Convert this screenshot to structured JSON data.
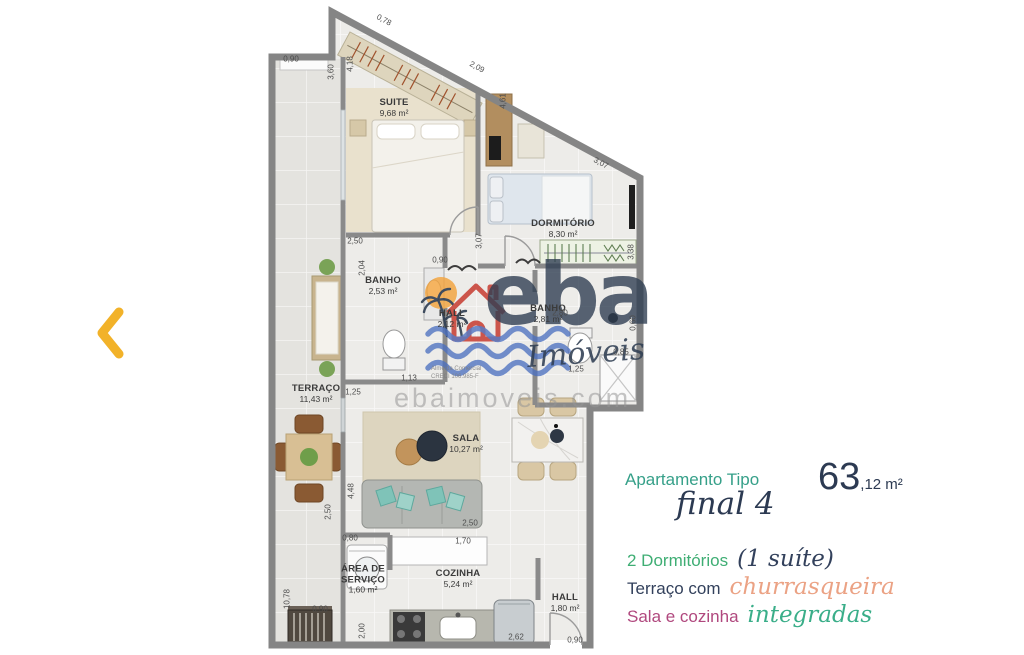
{
  "carousel": {
    "back_arrow_color": "#f2b229"
  },
  "watermark": {
    "brand": "eba",
    "brand_suffix": "Imóveis",
    "website": "ebaimoveis.com",
    "fine_print": [
      "Almeida Comercial",
      "CRECI 106.985-F"
    ],
    "colors": {
      "brand_navy": "#2f3e52",
      "house_red": "#c9453a",
      "sun_orange": "#f2a43f",
      "waves_blue": "#4a6fc0"
    }
  },
  "floorplan": {
    "rooms": [
      {
        "name": "SUITE",
        "area": "9,68 m²",
        "x": 394,
        "y": 108
      },
      {
        "name": "DORMITÓRIO",
        "area": "8,30 m²",
        "x": 563,
        "y": 229
      },
      {
        "name": "BANHO",
        "area": "2,53 m²",
        "x": 383,
        "y": 286
      },
      {
        "name": "HALL",
        "area": "2,12 m²",
        "x": 452,
        "y": 319
      },
      {
        "name": "BANHO",
        "area": "2,81 m²",
        "x": 548,
        "y": 314
      },
      {
        "name": "TERRAÇO",
        "area": "11,43 m²",
        "x": 316,
        "y": 394
      },
      {
        "name": "SALA",
        "area": "10,27 m²",
        "x": 466,
        "y": 444
      },
      {
        "name": "ÁREA DE\nSERVIÇO",
        "area": "1,60 m²",
        "x": 363,
        "y": 580
      },
      {
        "name": "COZINHA",
        "area": "5,24 m²",
        "x": 458,
        "y": 579
      },
      {
        "name": "HALL",
        "area": "1,80 m²",
        "x": 565,
        "y": 603
      }
    ],
    "dimensions": [
      {
        "t": "0,90",
        "x": 291,
        "y": 59,
        "r": 0
      },
      {
        "t": "3,60",
        "x": 331,
        "y": 72,
        "r": -90
      },
      {
        "t": "4,18",
        "x": 350,
        "y": 64,
        "r": -90
      },
      {
        "t": "0,78",
        "x": 384,
        "y": 20,
        "r": 28
      },
      {
        "t": "2,09",
        "x": 477,
        "y": 67,
        "r": 28
      },
      {
        "t": "4,61",
        "x": 503,
        "y": 101,
        "r": -90
      },
      {
        "t": "3,07",
        "x": 479,
        "y": 241,
        "r": -90
      },
      {
        "t": "3,07",
        "x": 601,
        "y": 163,
        "r": 28
      },
      {
        "t": "3,38",
        "x": 631,
        "y": 252,
        "r": -90
      },
      {
        "t": "2,50",
        "x": 355,
        "y": 241,
        "r": 0
      },
      {
        "t": "2,04",
        "x": 362,
        "y": 268,
        "r": -90
      },
      {
        "t": "0,90",
        "x": 440,
        "y": 260,
        "r": 0
      },
      {
        "t": "2,80",
        "x": 560,
        "y": 313,
        "r": 0
      },
      {
        "t": "0,60",
        "x": 633,
        "y": 323,
        "r": -90
      },
      {
        "t": "0,85",
        "x": 621,
        "y": 352,
        "r": 0
      },
      {
        "t": "1,25",
        "x": 576,
        "y": 369,
        "r": 0
      },
      {
        "t": "1,13",
        "x": 409,
        "y": 378,
        "r": 0
      },
      {
        "t": "1,25",
        "x": 353,
        "y": 392,
        "r": 0
      },
      {
        "t": "4,48",
        "x": 351,
        "y": 491,
        "r": -90
      },
      {
        "t": "2,50",
        "x": 328,
        "y": 512,
        "r": -90
      },
      {
        "t": "0,80",
        "x": 350,
        "y": 538,
        "r": 0
      },
      {
        "t": "2,50",
        "x": 470,
        "y": 523,
        "r": 0
      },
      {
        "t": "1,70",
        "x": 463,
        "y": 541,
        "r": 0
      },
      {
        "t": "10,78",
        "x": 287,
        "y": 599,
        "r": -90
      },
      {
        "t": "0,90",
        "x": 320,
        "y": 609,
        "r": 0
      },
      {
        "t": "2,00",
        "x": 362,
        "y": 631,
        "r": -90
      },
      {
        "t": "2,62",
        "x": 516,
        "y": 637,
        "r": 0
      },
      {
        "t": "0,90",
        "x": 575,
        "y": 640,
        "r": 0
      }
    ]
  },
  "info": {
    "type_label": "Apartamento Tipo",
    "type_label_color": "#36a089",
    "type_script": "final 4",
    "area_int": "63",
    "area_frac": ",12 m²",
    "features": [
      {
        "plain": "2 Dormitórios",
        "plain_color": "#3fae74",
        "script": "(1 suíte)",
        "script_color": "#33415c"
      },
      {
        "plain": "Terraço com",
        "plain_color": "#33415c",
        "script": "churrasqueira",
        "script_color": "#eba284"
      },
      {
        "plain": "Sala e cozinha",
        "plain_color": "#b0487e",
        "script": "integradas",
        "script_color": "#3aae89"
      }
    ]
  }
}
